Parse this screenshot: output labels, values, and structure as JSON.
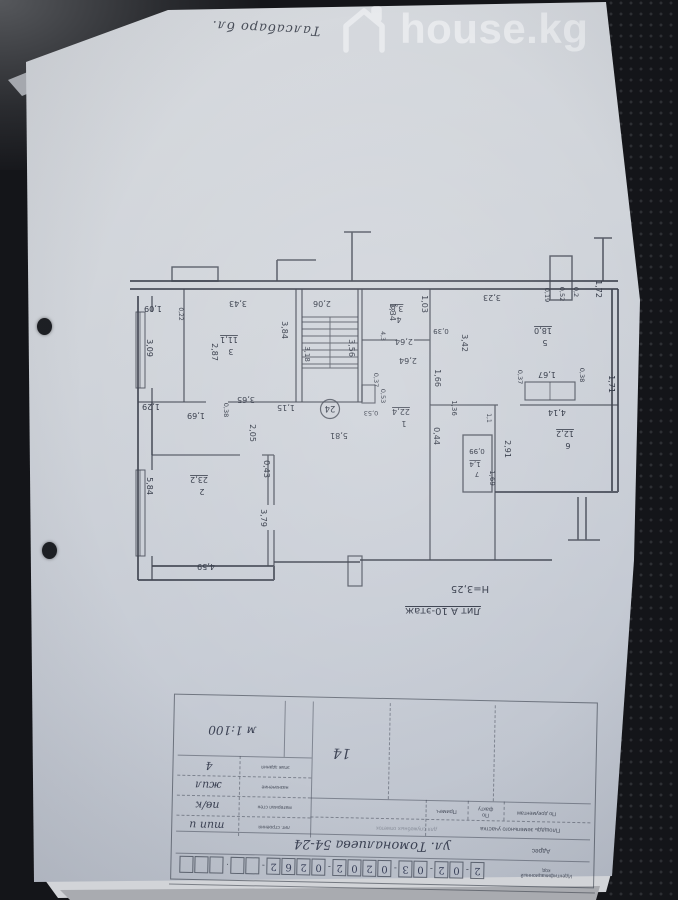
{
  "watermark": {
    "brand": "house.kg",
    "icon": "house-outline-icon"
  },
  "handwritten_top_note": "Талсабаро бл.",
  "floor_plan": {
    "building_note": "Лит А 10-этаж",
    "ceiling_height": "Н=3,25",
    "apartment_circle": "24",
    "rooms": [
      {
        "number": "1",
        "area": "22.4"
      },
      {
        "number": "2",
        "area": "23.2"
      },
      {
        "number": "3",
        "area": "11.1"
      },
      {
        "number": "4",
        "area": "3.8"
      },
      {
        "number": "5",
        "area": "18.0"
      },
      {
        "number": "6",
        "area": "12.2"
      },
      {
        "number": "7",
        "area": "1.4"
      }
    ],
    "labels": [
      {
        "t": "1,72",
        "x": 596,
        "y": 289,
        "v": 1
      },
      {
        "t": "0,2",
        "x": 574,
        "y": 292,
        "v": 1,
        "fs": 6.5
      },
      {
        "t": "0,52",
        "x": 560,
        "y": 294,
        "v": 1,
        "fs": 6.5
      },
      {
        "t": "0,19",
        "x": 545,
        "y": 295,
        "v": 1,
        "fs": 6.5
      },
      {
        "t": "3,23",
        "x": 492,
        "y": 295
      },
      {
        "t": "2,06",
        "x": 322,
        "y": 301
      },
      {
        "t": "1,03",
        "x": 422,
        "y": 304,
        "v": 1
      },
      {
        "t": "1,34",
        "x": 390,
        "y": 312,
        "v": 1
      },
      {
        "t": "3,8",
        "x": 397,
        "y": 306,
        "u": 1
      },
      {
        "t": "4",
        "x": 399,
        "y": 317
      },
      {
        "t": "1,09",
        "x": 153,
        "y": 306
      },
      {
        "t": "0,22",
        "x": 179,
        "y": 314,
        "v": 1,
        "fs": 6
      },
      {
        "t": "3,43",
        "x": 238,
        "y": 301
      },
      {
        "t": "3,09",
        "x": 147,
        "y": 348,
        "v": 1
      },
      {
        "t": "2,87",
        "x": 212,
        "y": 352,
        "v": 1
      },
      {
        "t": "3,84",
        "x": 282,
        "y": 330,
        "v": 1
      },
      {
        "t": "11,1",
        "x": 229,
        "y": 337,
        "u": 1
      },
      {
        "t": "3",
        "x": 231,
        "y": 349
      },
      {
        "t": "3,18",
        "x": 305,
        "y": 354,
        "v": 1,
        "fs": 7
      },
      {
        "t": "3,56",
        "x": 349,
        "y": 348,
        "v": 1
      },
      {
        "t": "2,64",
        "x": 404,
        "y": 339
      },
      {
        "t": "2,64",
        "x": 408,
        "y": 358
      },
      {
        "t": "0,39",
        "x": 441,
        "y": 329,
        "fs": 7
      },
      {
        "t": "4,3",
        "x": 381,
        "y": 336,
        "v": 1,
        "fs": 6
      },
      {
        "t": "3,42",
        "x": 462,
        "y": 343,
        "v": 1
      },
      {
        "t": "18,0",
        "x": 543,
        "y": 328,
        "u": 1
      },
      {
        "t": "5",
        "x": 545,
        "y": 340
      },
      {
        "t": "3,65",
        "x": 246,
        "y": 397
      },
      {
        "t": "1,15",
        "x": 286,
        "y": 405
      },
      {
        "t": "1,29",
        "x": 151,
        "y": 404
      },
      {
        "t": "1,69",
        "x": 196,
        "y": 413
      },
      {
        "t": "0,38",
        "x": 224,
        "y": 410,
        "v": 1,
        "fs": 6.5
      },
      {
        "t": "2,05",
        "x": 250,
        "y": 433,
        "v": 1
      },
      {
        "t": "0,43",
        "x": 264,
        "y": 469,
        "v": 1
      },
      {
        "t": "5,84",
        "x": 147,
        "y": 486,
        "v": 1
      },
      {
        "t": "23,2",
        "x": 199,
        "y": 477,
        "u": 1
      },
      {
        "t": "2",
        "x": 202,
        "y": 489
      },
      {
        "t": "3,79",
        "x": 261,
        "y": 518,
        "v": 1
      },
      {
        "t": "4,59",
        "x": 206,
        "y": 564
      },
      {
        "t": "1,66",
        "x": 435,
        "y": 378,
        "v": 1
      },
      {
        "t": "0,37",
        "x": 374,
        "y": 380,
        "v": 1,
        "fs": 6.5
      },
      {
        "t": "0,53",
        "x": 381,
        "y": 396,
        "v": 1,
        "fs": 6.5
      },
      {
        "t": "0,53",
        "x": 371,
        "y": 411,
        "fs": 6.5
      },
      {
        "t": "22,4",
        "x": 401,
        "y": 409,
        "u": 1
      },
      {
        "t": "1",
        "x": 404,
        "y": 421
      },
      {
        "t": "0,44",
        "x": 434,
        "y": 436,
        "v": 1
      },
      {
        "t": "5,81",
        "x": 339,
        "y": 433
      },
      {
        "t": "1,36",
        "x": 452,
        "y": 408,
        "v": 1,
        "fs": 7
      },
      {
        "t": "1,1",
        "x": 487,
        "y": 418,
        "v": 1,
        "fs": 6
      },
      {
        "t": "0,99",
        "x": 477,
        "y": 449,
        "fs": 7
      },
      {
        "t": "1,4",
        "x": 475,
        "y": 462,
        "u": 1,
        "fs": 7
      },
      {
        "t": "7",
        "x": 477,
        "y": 472,
        "fs": 7
      },
      {
        "t": "1,69",
        "x": 490,
        "y": 478,
        "v": 1,
        "fs": 7
      },
      {
        "t": "0,37",
        "x": 518,
        "y": 377,
        "v": 1,
        "fs": 6.5
      },
      {
        "t": "1,67",
        "x": 547,
        "y": 372
      },
      {
        "t": "0,38",
        "x": 580,
        "y": 375,
        "v": 1,
        "fs": 6.5
      },
      {
        "t": "1,71",
        "x": 609,
        "y": 384,
        "v": 1
      },
      {
        "t": "4,14",
        "x": 557,
        "y": 410
      },
      {
        "t": "12,2",
        "x": 565,
        "y": 431,
        "u": 1
      },
      {
        "t": "6",
        "x": 568,
        "y": 443
      },
      {
        "t": "2,91",
        "x": 505,
        "y": 449,
        "v": 1
      }
    ]
  },
  "stamp": {
    "scale_note": "м 1:100",
    "cell_number": "14",
    "left_rows": [
      {
        "label": "этаж здания",
        "value": "4"
      },
      {
        "label": "назначение",
        "value": "жил"
      },
      {
        "label": "материал стен",
        "value": "пв/к"
      },
      {
        "label": "лит. строения",
        "value": "тип и"
      }
    ],
    "area_section": {
      "title": "Площадь земельного участка",
      "col_docs": "По документам",
      "col_fact": "По факту",
      "col_note": "Примеч.",
      "service_note": "для служебных отметок"
    },
    "address": {
      "label": "Адрес",
      "value": "ул. Томоналиева 54-24"
    },
    "id_code": {
      "label": "Идентификационный код",
      "groups": [
        "2",
        "02",
        "03",
        "0202",
        "0262",
        "",
        ""
      ],
      "group_sizes": [
        1,
        2,
        2,
        4,
        4,
        2,
        3
      ]
    }
  }
}
